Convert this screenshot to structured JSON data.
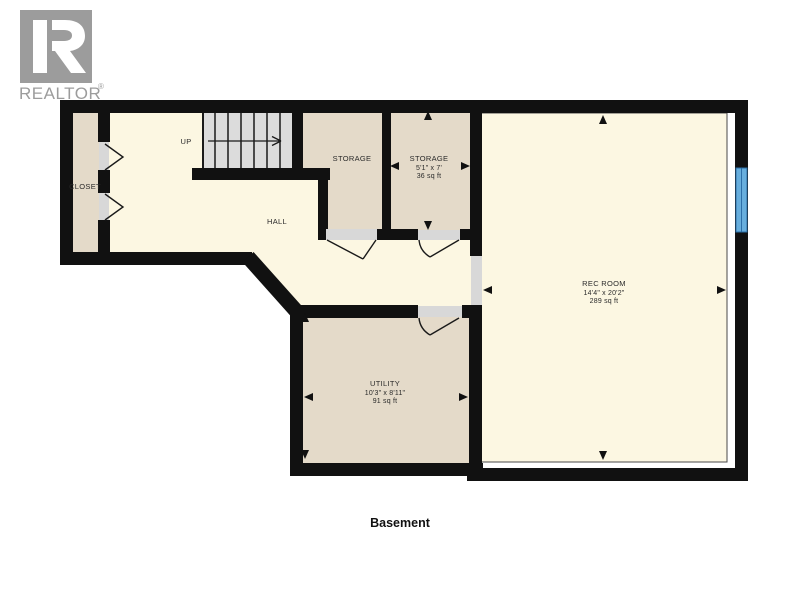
{
  "brand": {
    "logo_text": "REALTOR",
    "registered_mark": "®",
    "logo_color": "#9c9c9c"
  },
  "floor_label": "Basement",
  "rooms": {
    "closet": {
      "label": "CLOSET"
    },
    "hall": {
      "label": "HALL"
    },
    "stairs": {
      "direction_label": "UP"
    },
    "storage_small": {
      "label": "STORAGE"
    },
    "storage_large": {
      "label": "STORAGE",
      "dimensions": "5'1\" x 7'",
      "area": "36 sq ft"
    },
    "rec_room": {
      "label": "REC ROOM",
      "dimensions": "14'4\" x 20'2\"",
      "area": "289 sq ft"
    },
    "utility": {
      "label": "UTILITY",
      "dimensions": "10'3\" x 8'11\"",
      "area": "91 sq ft"
    }
  },
  "colors": {
    "wall": "#111111",
    "hall_floor": "#fcf7e2",
    "room_floor": "#e4dac9",
    "stairs_fill": "#dcdcdc",
    "door_threshold": "#d8d8d8",
    "window_blue": "#67aedd",
    "logo_gray": "#9c9c9c"
  }
}
